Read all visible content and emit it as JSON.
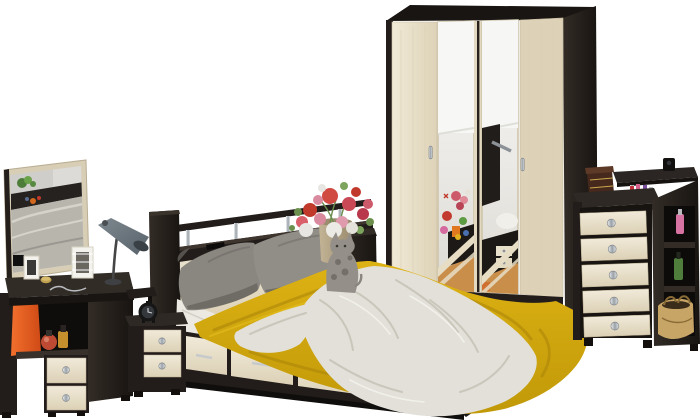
{
  "scene": {
    "description": "Product photo of a bedroom furniture set in dark wenge and light oak on a white background: vanity with mirror, desk lamp, bedside cabinet, double bed with storage drawers and headboard shelf, four-door wardrobe with two mirrored doors, and a chest of drawers with open side shelves."
  },
  "palette": {
    "floor": "#ffffff",
    "wenge": "#221d1a",
    "wengeLight": "#38312b",
    "wengeDark": "#120f0d",
    "cream": "#ebe3cf",
    "creamShade": "#d8cdb3",
    "mirrorFrame": "#d8ceb6",
    "yellow": "#d3a70d",
    "yellowDeep": "#a9840a",
    "blanket": "#e2e0d8",
    "blanketShade": "#c6c3b8",
    "pillow": "#8a8680",
    "pillowDark": "#6f6b65",
    "chrome": "#c9ccd0",
    "orange": "#e75b20",
    "lampGray": "#6e7a81",
    "tan": "#c7a566",
    "vase": "#b5a486"
  },
  "objects": {
    "mirror": "vanity wall mirror",
    "vanity": "vanity desk with drawers",
    "shoppingBag": "orange shopping bag",
    "perfume": "perfume bottles",
    "photoFrames": "photo frames",
    "lamp": "grey desk lamp",
    "sideShelf": "side shelf",
    "nightstand": "bedside cabinet",
    "alarmClock": "alarm clock",
    "bed": "double bed with storage drawers",
    "headboard": "headboard shelf with chrome posts",
    "pillows": "grey pillows",
    "bedspread": "mustard bedspread",
    "throw": "white throw blanket",
    "vaseFlowers": "vase with flowers",
    "cat": "cat figurine",
    "wardrobe": "four-door wardrobe with mirrored doors",
    "chest": "chest of drawers with side shelves",
    "handbag": "tan handbag",
    "cosmetics": "cosmetics tray",
    "woodenBox": "wooden jewellery box"
  }
}
